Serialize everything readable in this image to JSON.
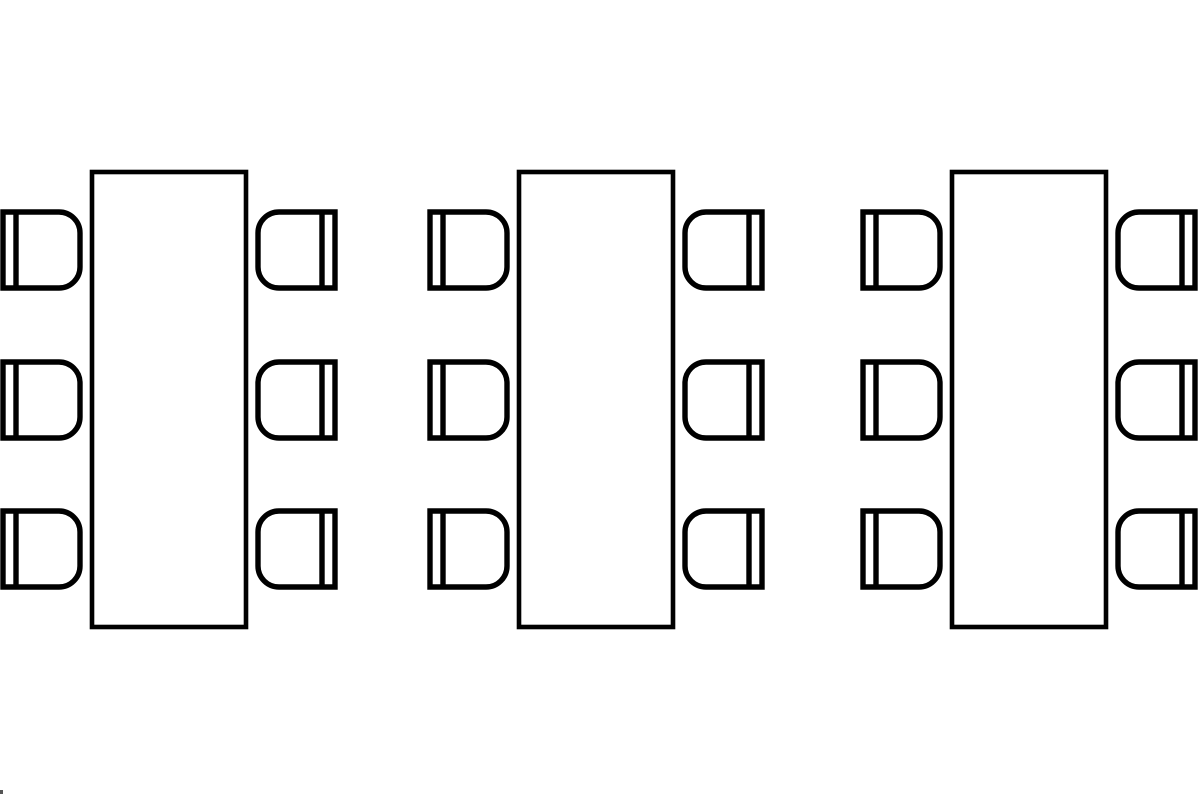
{
  "diagram": {
    "canvas": {
      "width": 1200,
      "height": 800,
      "background": "#ffffff"
    },
    "style": {
      "stroke_color": "#000000",
      "fill_color": "#ffffff",
      "table_stroke_width": 4.6,
      "chair_stroke_width": 5.4
    },
    "table": {
      "offset_x": 89,
      "y": 172,
      "width": 154,
      "height": 455
    },
    "chair": {
      "width": 77,
      "height": 76,
      "corner_radius": 21,
      "backrest_inset": 13
    },
    "chair_row_y": [
      212,
      362,
      511
    ],
    "right_chair_offset_x": 255,
    "groups": [
      {
        "name": "table-group-1",
        "x": 3,
        "chairs_left": 3,
        "chairs_right": 3
      },
      {
        "name": "table-group-2",
        "x": 430,
        "chairs_left": 3,
        "chairs_right": 3
      },
      {
        "name": "table-group-3",
        "x": 863,
        "chairs_left": 3,
        "chairs_right": 3
      }
    ],
    "stray_mark": {
      "x": 0,
      "y": 790,
      "width": 3,
      "height": 4,
      "color": "#555555"
    }
  }
}
